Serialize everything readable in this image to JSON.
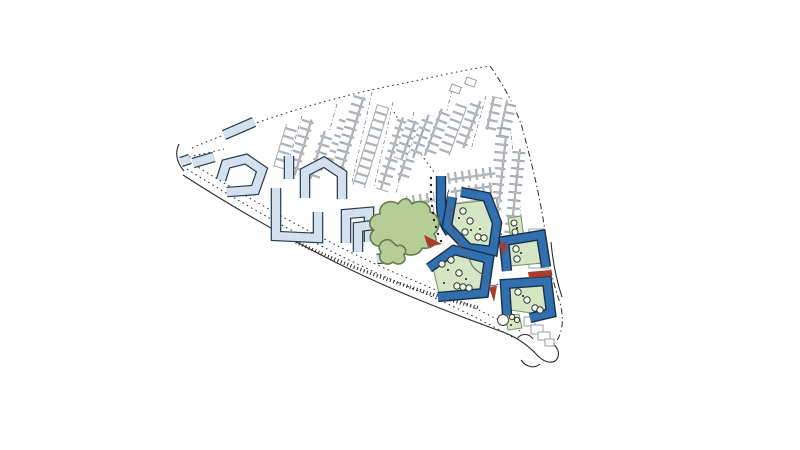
{
  "title": "masterplan-site-plan",
  "colors": {
    "paper": "#ffffff",
    "ink": "#2b2b2b",
    "existing": "#979da4",
    "lb_fill": "#d3e1ee",
    "lb_edge": "#233a50",
    "nb_fill": "#316fae",
    "nb_edge": "#17314e",
    "green": "#d6e5c3",
    "green_edge": "#7b9060",
    "tree_fill": "#b5ce96",
    "tree_edge": "#667c4e",
    "red": "#a93c2a",
    "stream": "#566070",
    "dotc": "#1e1e1e"
  },
  "legend": {
    "existing_housing": "existing terraced housing (outline)",
    "proposed_light_blocks": "perimeter housing blocks (light blue)",
    "new_dark_blocks": "new courtyard blocks (dark blue)",
    "courtyards": "green courtyards with trees",
    "park_tree": "large park tree cluster",
    "accents": "red gateway markers"
  }
}
